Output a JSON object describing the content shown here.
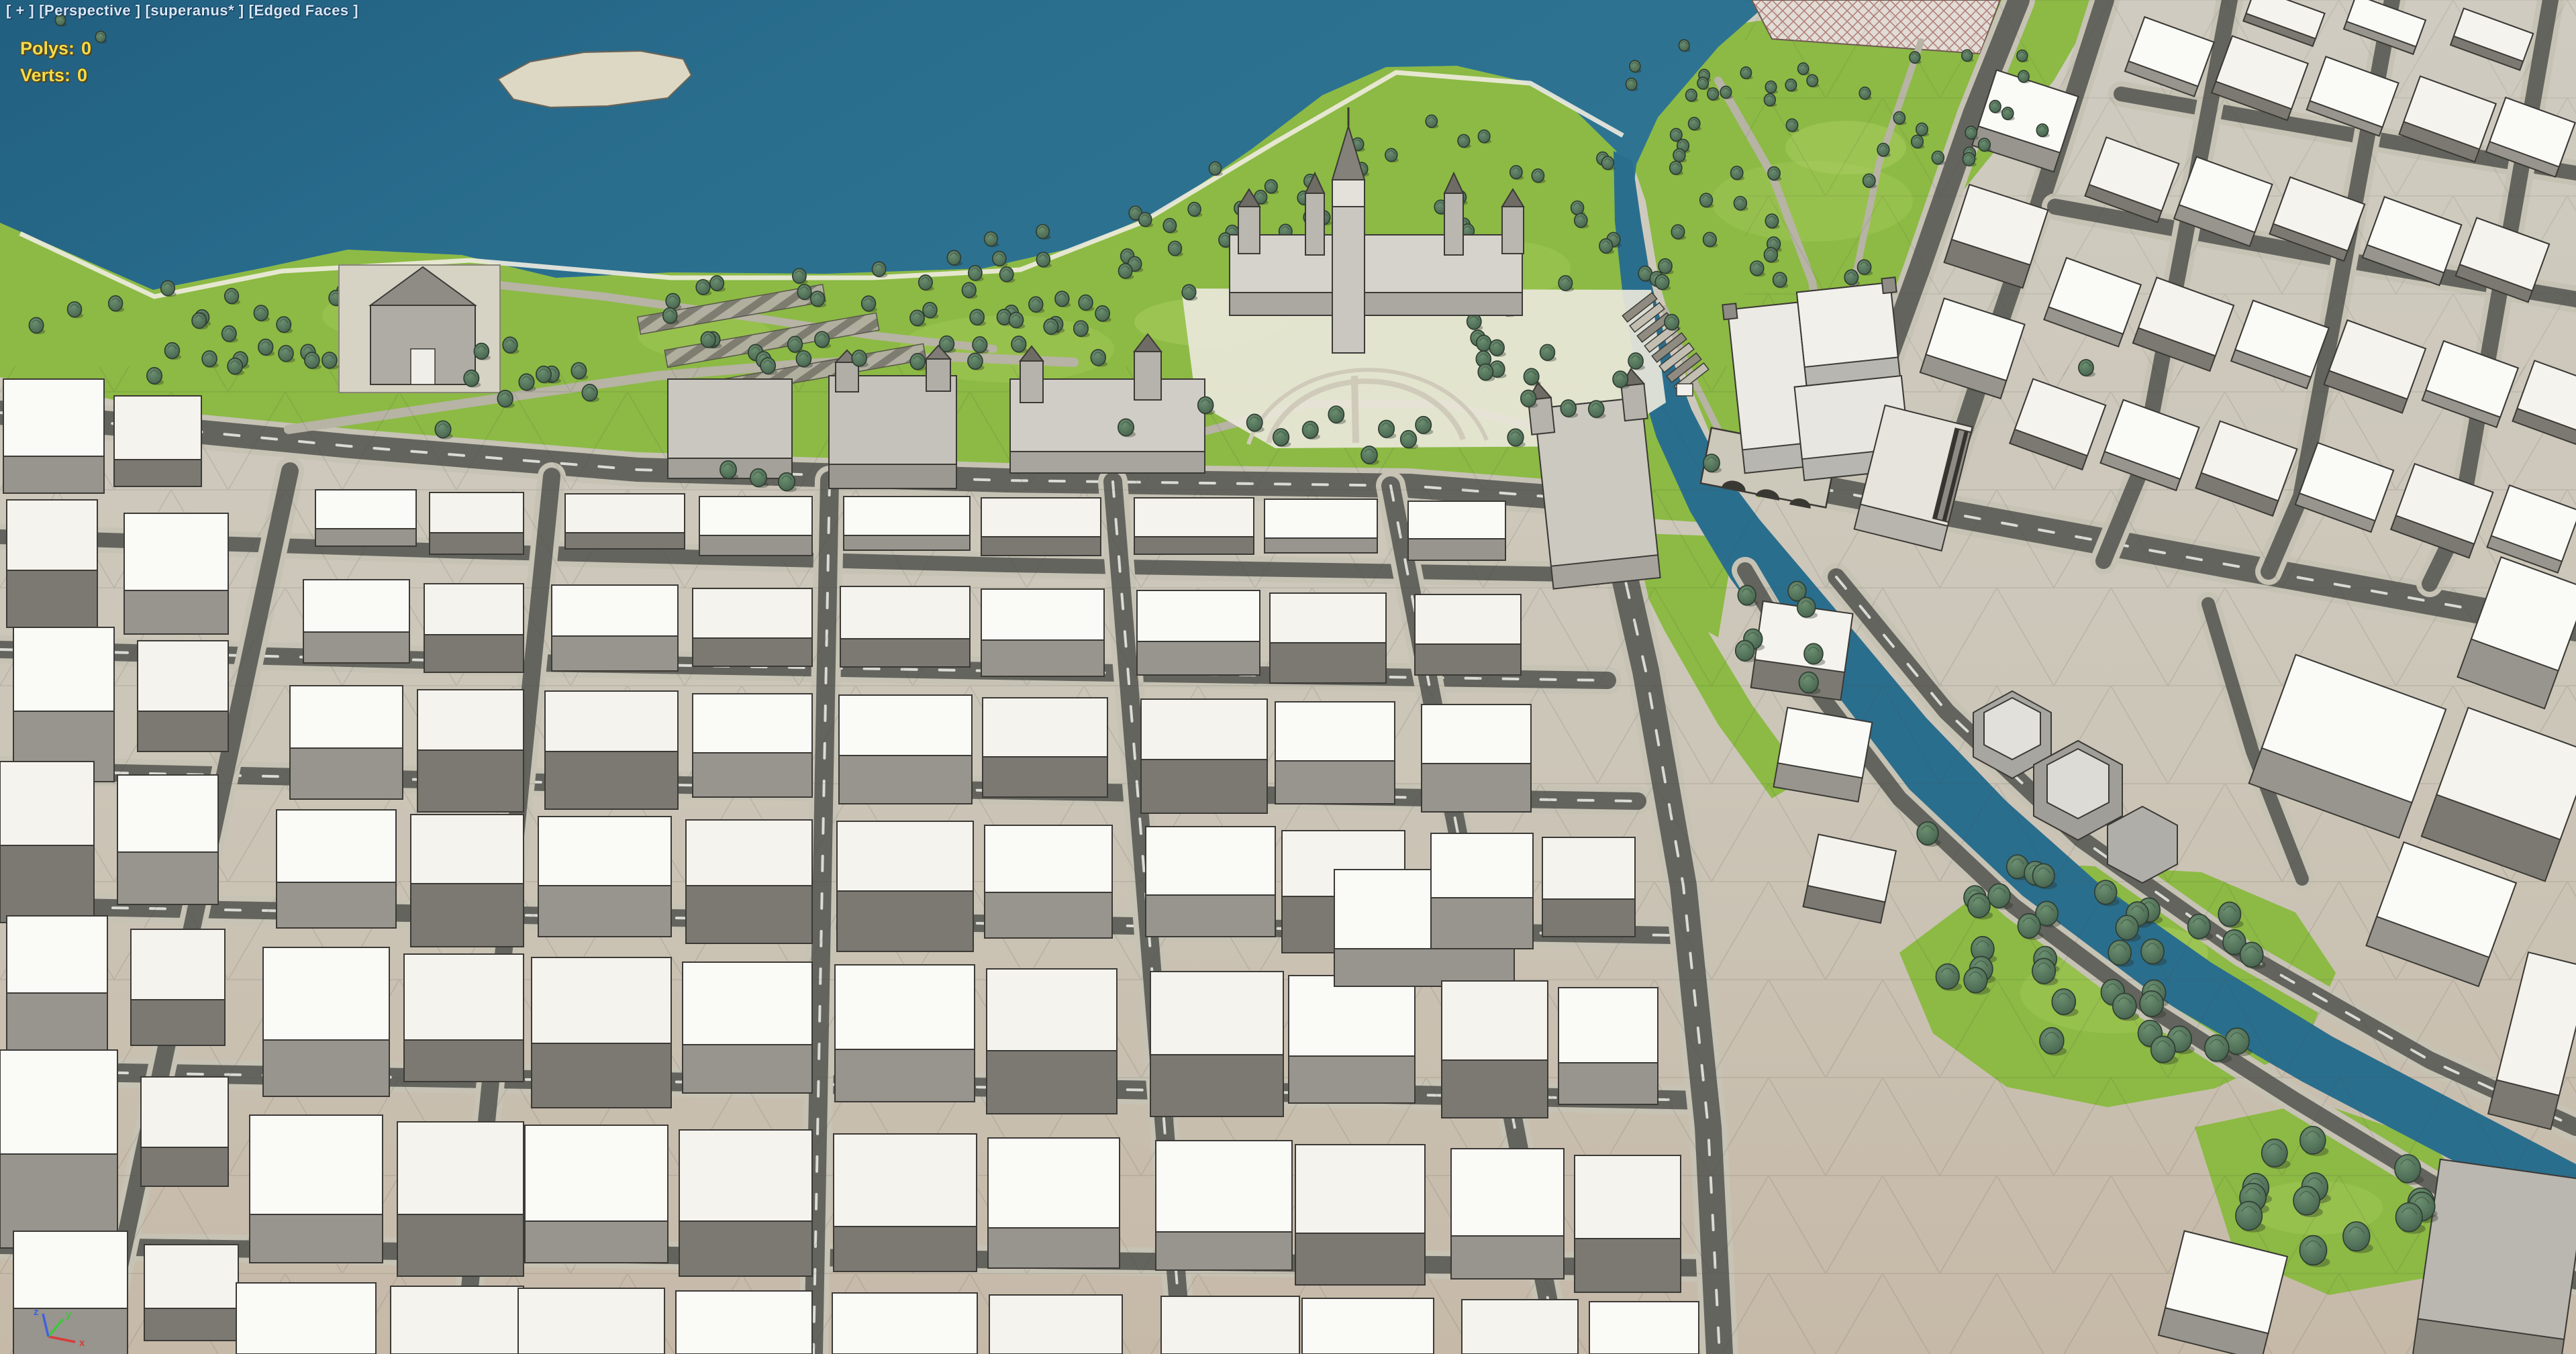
{
  "viewport": {
    "label": {
      "menu_toggle": "[ + ]",
      "view_name": "[Perspective ]",
      "object_name": "[superanus* ]",
      "shading_mode": "[Edged Faces ]"
    },
    "statistics": {
      "polys_label": "Polys:",
      "polys_value": "0",
      "verts_label": "Verts:",
      "verts_value": "0"
    },
    "axis_tripod": {
      "x_label": "x",
      "y_label": "y",
      "z_label": "z"
    }
  },
  "colors": {
    "water": "#2a6e8e",
    "water_deep": "#1f5c7c",
    "canal": "#2e7391",
    "grass": "#8cba44",
    "grass_light": "#b5d468",
    "tree_fill": "#4c6b52",
    "tree_light": "#6c8f70",
    "tree_edge": "#2e3c31",
    "road_asphalt": "#64645e",
    "sidewalk": "#c6c2b4",
    "ground": "#cfcbc0",
    "ground_warm": "#c6b9a8",
    "roof_white": "#fafaf7",
    "wall_gray": "#97958d",
    "wall_dark": "#7b7972",
    "stone": "#b5b3ac",
    "stone_light": "#dddbd3",
    "wireframe": "#3f3b35",
    "island_sand": "#ddd8c4",
    "plaza": "#e9e7da",
    "lane_dash": "#e8e8e2",
    "label_text": "#d8e8fa",
    "stats_text": "#f0dd4e",
    "axis_x": "#d83c3c",
    "axis_y": "#3cc83c",
    "axis_z": "#4060e0"
  }
}
